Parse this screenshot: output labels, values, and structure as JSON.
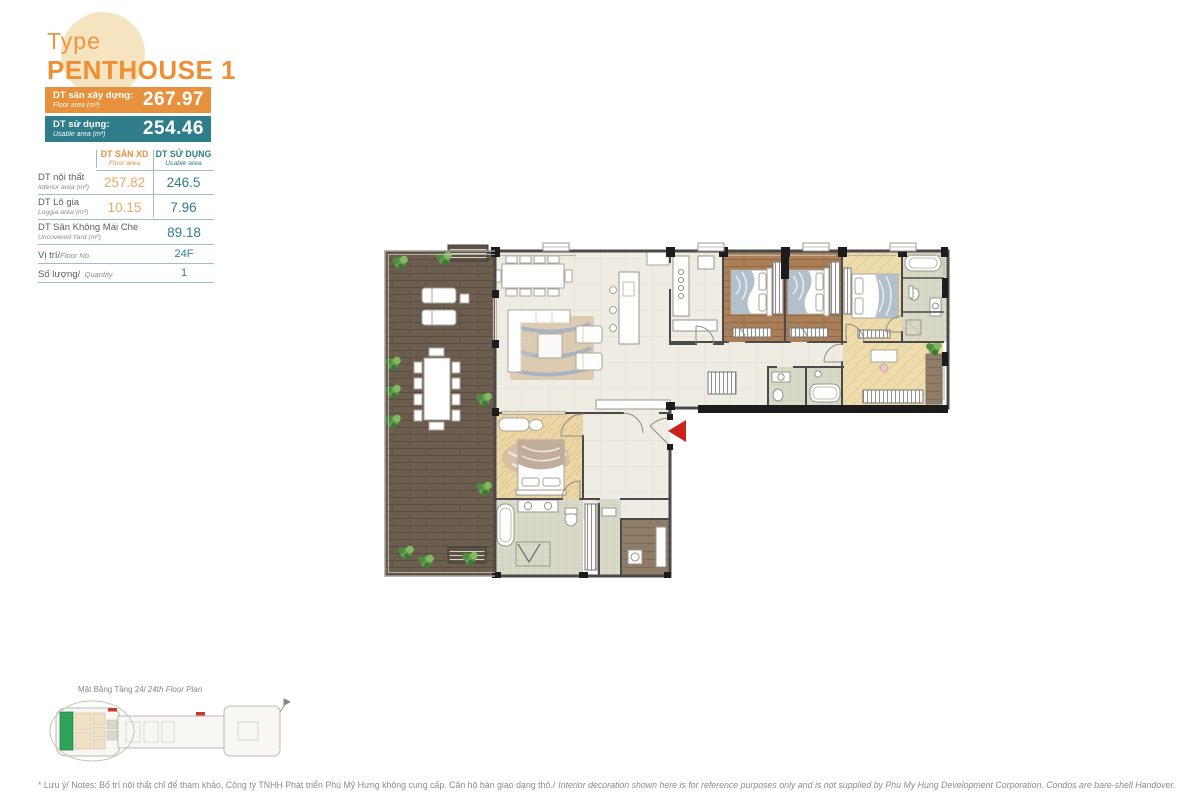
{
  "brand": {
    "type_label": "Type",
    "title": "PENTHOUSE 1"
  },
  "banners": {
    "floor": {
      "label_vi": "DT sàn xây dựng:",
      "label_en": "Floor area (m²)",
      "value": "267.97"
    },
    "usable": {
      "label_vi": "DT sử dụng:",
      "label_en": "Usable area (m²)",
      "value": "254.46"
    }
  },
  "area_table": {
    "headers": {
      "floor": {
        "vi": "DT SÀN XD",
        "en": "Floor area"
      },
      "usable": {
        "vi": "DT SỬ DỤNG",
        "en": "Usable area"
      }
    },
    "rows": {
      "interior": {
        "vi": "DT nội thất",
        "en": "Interior area (m²)",
        "floor": "257.82",
        "usable": "246.5"
      },
      "loggia": {
        "vi": "DT Lô gia",
        "en": "Loggia area (m²)",
        "floor": "10.15",
        "usable": "7.96"
      },
      "uncovered": {
        "vi": "DT Sân Không Mái Che",
        "en": "Uncovered Yard (m²)",
        "value": "89.18"
      },
      "position": {
        "vi": "Vị trí/",
        "en": "Floor No.",
        "value": "24F"
      },
      "quantity": {
        "vi": "Số lượng/",
        "en": "Quantity",
        "value": "1"
      }
    }
  },
  "key_plan": {
    "caption_vi": "Mặt Bằng Tầng 24/",
    "caption_en": "24th Floor Plan"
  },
  "notes": {
    "vi": "* Lưu ý/ Notes: Bố trí nội thất chỉ để tham khảo, Công ty TNHH Phát triển Phú Mỹ Hưng không cung cấp. Căn hộ bàn giao dạng thô./",
    "en": "Interior decoration shown here is for reference purposes only and is not supplied by Phu My Hung Development Corporation. Condos are bare-shell Handover."
  },
  "colors": {
    "orange": "#E8913C",
    "teal": "#2F7D8A",
    "value_orange": "#E8A960",
    "entry_arrow_red": "#CB231A",
    "keyplan_unit_green": "#2FA358"
  }
}
